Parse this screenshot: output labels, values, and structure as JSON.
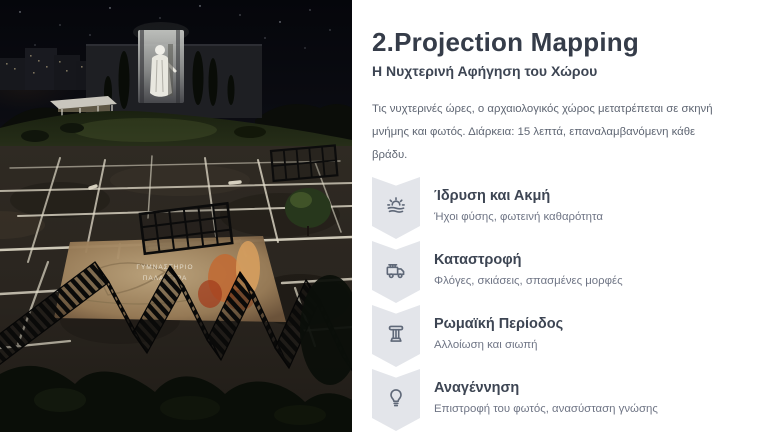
{
  "panel": {
    "title": "2.Projection Mapping",
    "subtitle": "Η Νυχτερινή Αφήγηση του Χώρου",
    "intro": "Τις νυχτερινές ώρες, ο αρχαιολογικός χώρος μετατρέπεται σε σκηνή μνήμης και φωτός. Διάρκεια: 15 λεπτά, επαναλαμβανόμενη κάθε βράδυ.",
    "items": [
      {
        "title": "Ίδρυση και Ακμή",
        "description": "Ήχοι φύσης, φωτεινή καθαρότητα",
        "icon": "sunrise-icon"
      },
      {
        "title": "Καταστροφή",
        "description": "Φλόγες, σκιάσεις, σπασμένες μορφές",
        "icon": "fire-truck-icon"
      },
      {
        "title": "Ρωμαϊκή Περίοδος",
        "description": "Αλλοίωση και σιωπή",
        "icon": "column-icon"
      },
      {
        "title": "Αναγέννηση",
        "description": "Επιστροφή του φωτός, ανασύσταση γνώσης",
        "icon": "lightbulb-icon"
      }
    ],
    "colors": {
      "title_text": "#353c49",
      "body_text": "#5f6673",
      "description_text": "#6f7585",
      "chevron_fill": "#e3e5ea",
      "icon_stroke": "#5f6878",
      "panel_background": "#ffffff"
    }
  },
  "scene": {
    "alt": "Night aerial render of an archaeological site with projection mapping of a classical statue on a building and illuminated excavation trenches",
    "ground_label_line1": "ΓΥΜΝΑΣΤΗΡΙΟ",
    "ground_label_line2": "ΠΑΛΑΙΣΤΡΑ"
  }
}
